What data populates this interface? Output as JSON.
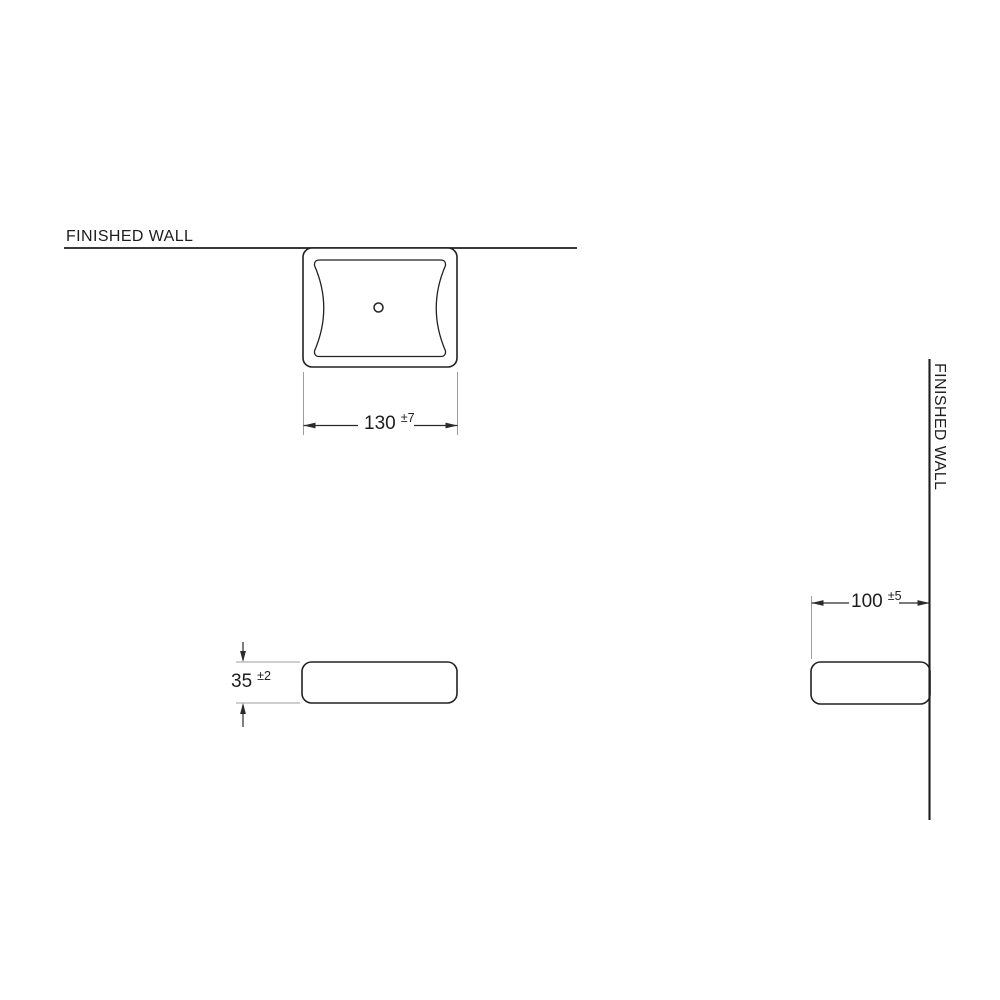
{
  "drawing": {
    "wall_labels": {
      "top": "FINISHED WALL",
      "right": "FINISHED WALL"
    },
    "dimensions": {
      "width": {
        "value": "130",
        "tolerance": "±7"
      },
      "thickness": {
        "value": "35",
        "tolerance": "±2"
      },
      "depth": {
        "value": "100",
        "tolerance": "±5"
      }
    },
    "colors": {
      "background": "#ffffff",
      "wall_line": "#1d1d1d",
      "object_outline": "#222222",
      "dimension_line": "#2a2a2a",
      "extension_line": "#9e9e9e",
      "text": "#1d1d1d"
    }
  }
}
